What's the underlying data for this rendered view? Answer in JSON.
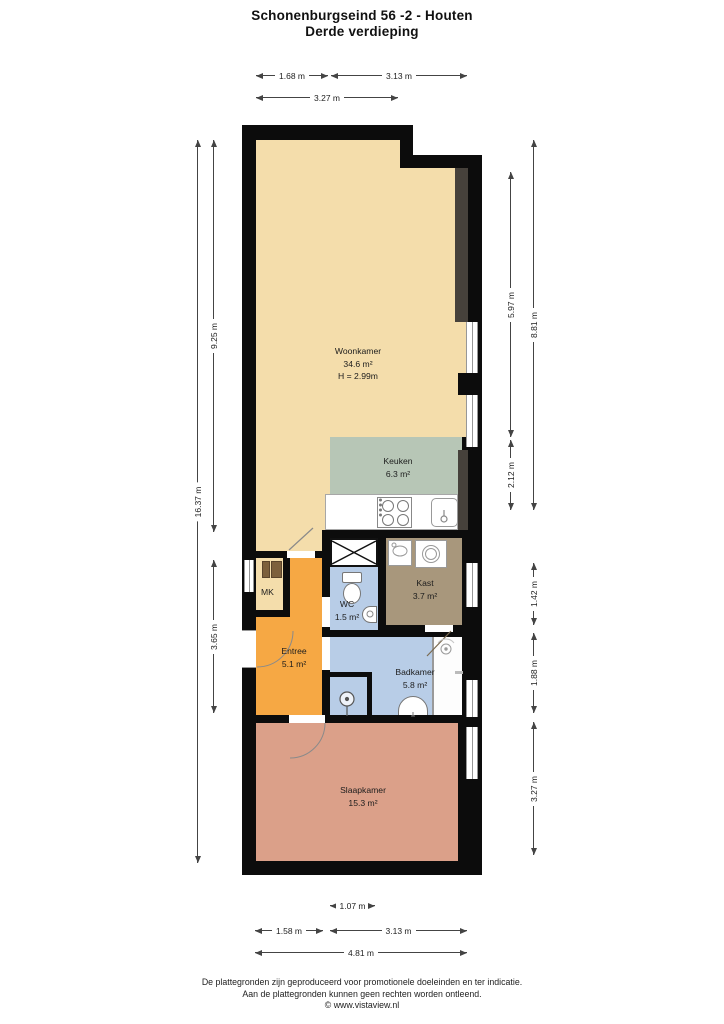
{
  "title": {
    "line1": "Schonenburgseind 56 -2 - Houten",
    "line2": "Derde verdieping"
  },
  "rooms": [
    {
      "name": "Woonkamer",
      "area": "34.6 m²",
      "extra": "H = 2.99m"
    },
    {
      "name": "Keuken",
      "area": "6.3 m²"
    },
    {
      "name": "Kast",
      "area": "3.7 m²"
    },
    {
      "name": "WC",
      "area": "1.5 m²"
    },
    {
      "name": "Entree",
      "area": "5.1 m²"
    },
    {
      "name": "Badkamer",
      "area": "5.8 m²"
    },
    {
      "name": "Slaapkamer",
      "area": "15.3 m²"
    },
    {
      "name": "MK"
    }
  ],
  "dimensions": {
    "top": [
      "1.68 m",
      "3.13 m",
      "3.27 m"
    ],
    "bottom": [
      "1.07 m",
      "1.58 m",
      "3.13 m",
      "4.81 m"
    ],
    "left": [
      "16.37 m",
      "9.25 m",
      "3.65 m"
    ],
    "right": [
      "5.97 m",
      "2.12 m",
      "8.81 m",
      "1.42 m",
      "1.88 m",
      "3.27 m"
    ]
  },
  "footer": {
    "line1": "De plattegronden zijn geproduceerd voor promotionele doeleinden en ter indicatie.",
    "line2": "Aan de plattegronden kunnen geen rechten worden ontleend.",
    "line3": "© www.vistaview.nl"
  },
  "colors": {
    "wall": "#0c0c0c",
    "woonkamer": "#f4ddab",
    "keuken": "#b7c6b6",
    "entree": "#f6a844",
    "wc_badkamer": "#b8cde7",
    "kast": "#a8977c",
    "slaapkamer": "#dba089",
    "window_recess": "#46413b"
  }
}
